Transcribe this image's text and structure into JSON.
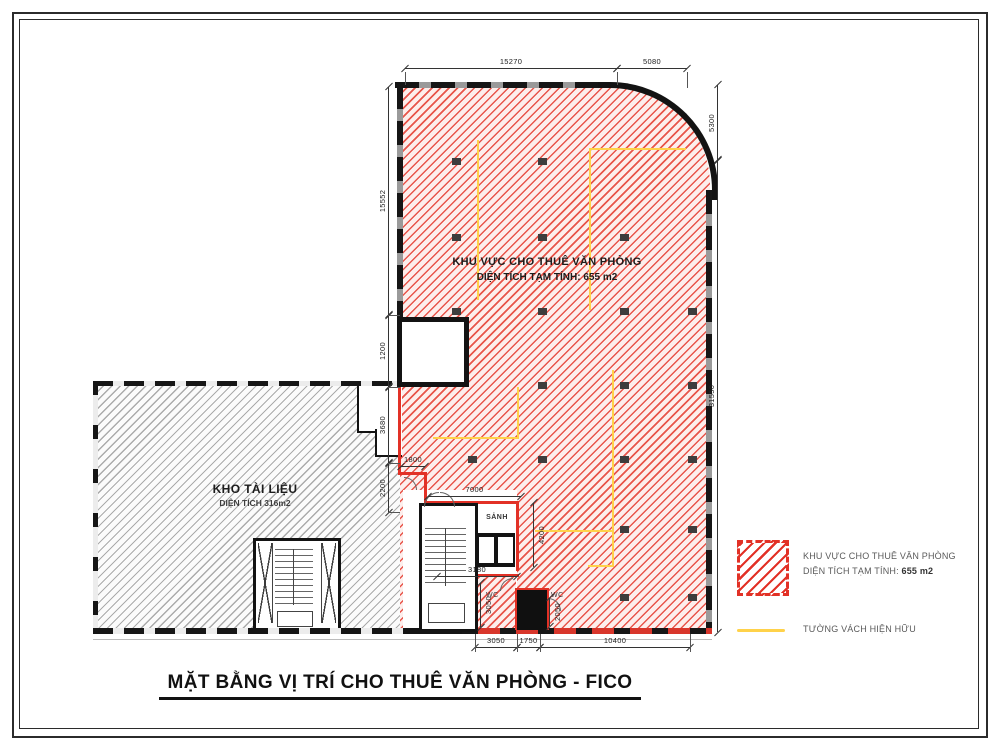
{
  "title": {
    "text": "MẶT BẰNG VỊ TRÍ CHO THUÊ VĂN PHÒNG - FICO"
  },
  "zones": {
    "office": {
      "name": "KHU VỰC CHO THUÊ VĂN PHÒNG",
      "area": "DIỆN TÍCH TẠM TÍNH: 655 m2"
    },
    "storage": {
      "name": "KHO TÀI LIỆU",
      "area": "DIỆN TÍCH 316m2"
    },
    "lobby": "SẢNH",
    "wc_left": "WC",
    "wc_right": "WC"
  },
  "legend": {
    "office_line1": "KHU VỰC CHO THUÊ VĂN PHÒNG",
    "office_line2_label": "DIỆN TÍCH TẠM TÍNH:",
    "office_line2_value": "655 m2",
    "wall_label": "TƯỜNG VÁCH HIỆN HỮU"
  },
  "dimensions": {
    "top": [
      "15270",
      "5080"
    ],
    "right": [
      "5300",
      "31550"
    ],
    "left": [
      "15552",
      "1200",
      "3680",
      "2200"
    ],
    "bottom": [
      "3050",
      "1750",
      "10400"
    ],
    "inner": [
      "1800",
      "7000",
      "3180",
      "4200",
      "3050",
      "2050"
    ]
  },
  "colors": {
    "lease_area_hatch": "#e23126",
    "existing_wall": "#ffd24a",
    "storage_hatch": "#9a9a9a"
  }
}
